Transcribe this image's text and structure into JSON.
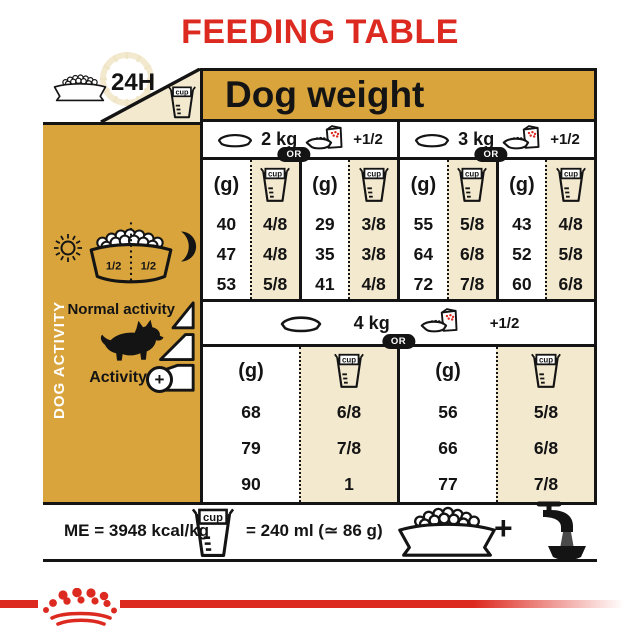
{
  "title": "FEEDING TABLE",
  "colors": {
    "brand_red": "#DD2A20",
    "gold": "#D9A43C",
    "cream": "#F3E9CF",
    "ink": "#141414"
  },
  "top": {
    "hours_label": "24H",
    "dog_weight_label": "Dog weight"
  },
  "cup_label": "cup",
  "sidebar": {
    "vertical_label": "DOG ACTIVITY",
    "bowl_half_left": "1/2",
    "bowl_half_right": "1/2",
    "normal_activity_label": "Normal activity",
    "activity_label": "Activity",
    "activity_plus": "+"
  },
  "table": {
    "unit_label": "(g)",
    "or_label": "OR",
    "plus_half_label": "+1/2",
    "sections": [
      {
        "weight": "2 kg",
        "grams_bowl": [
          "40",
          "47",
          "53"
        ],
        "cups_bowl": [
          "4/8",
          "4/8",
          "5/8"
        ],
        "grams_pouch": [
          "29",
          "35",
          "41"
        ],
        "cups_pouch": [
          "3/8",
          "3/8",
          "4/8"
        ]
      },
      {
        "weight": "3 kg",
        "grams_bowl": [
          "55",
          "64",
          "72"
        ],
        "cups_bowl": [
          "5/8",
          "6/8",
          "7/8"
        ],
        "grams_pouch": [
          "43",
          "52",
          "60"
        ],
        "cups_pouch": [
          "4/8",
          "5/8",
          "6/8"
        ]
      },
      {
        "weight": "4 kg",
        "grams_bowl": [
          "68",
          "79",
          "90"
        ],
        "cups_bowl": [
          "6/8",
          "7/8",
          "1"
        ],
        "grams_pouch": [
          "56",
          "66",
          "77"
        ],
        "cups_pouch": [
          "5/8",
          "6/8",
          "7/8"
        ]
      }
    ]
  },
  "footer": {
    "me_label": "ME = 3948 kcal/kg",
    "cup_equals_label": "= 240 ml (≃ 86 g)",
    "plus_sign": "+"
  }
}
